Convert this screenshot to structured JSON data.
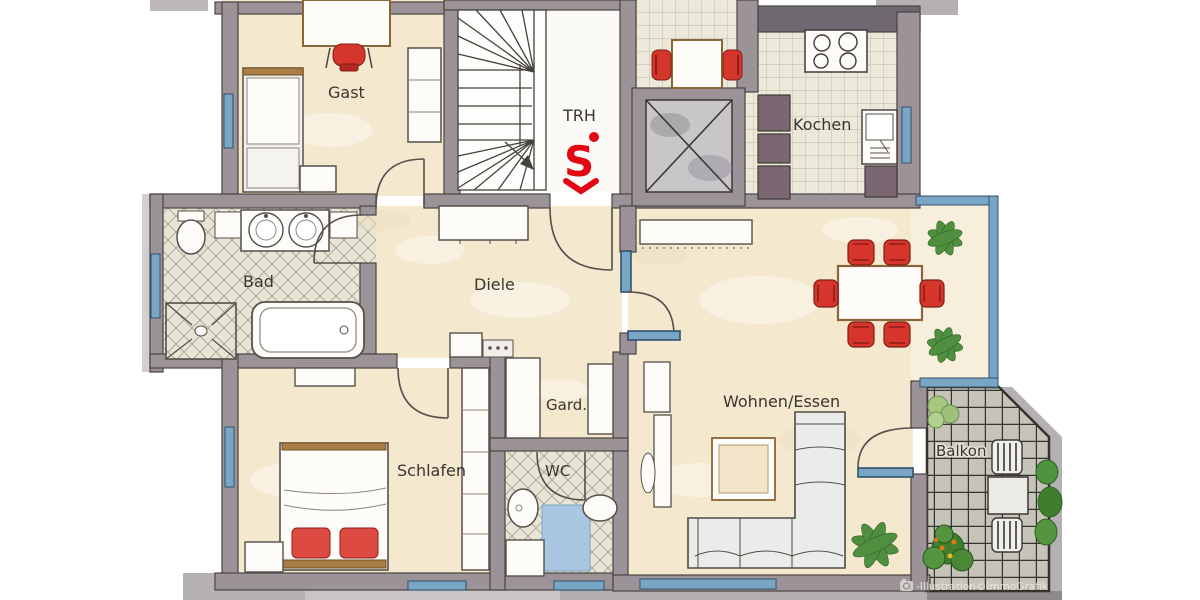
{
  "plan": {
    "type": "apartment-floor-plan",
    "rooms": {
      "gast": "Gast",
      "trh": "TRH",
      "kochen": "Kochen",
      "bad": "Bad",
      "diele": "Diele",
      "gard": "Gard.",
      "schlafen": "Schlafen",
      "wc": "WC",
      "wohnen_essen": "Wohnen/Essen",
      "balkon": "Balkon"
    },
    "logo": {
      "name": "sparkasse-logo",
      "letter": "S"
    },
    "watermark": "-Illustration©ImmoGrafik",
    "colors": {
      "floor_cream": "#f4e8cf",
      "wall_gray": "#9c9399",
      "accent_red": "#d6352c",
      "window_blue": "#7aa6c6",
      "counter_dark": "#7b6771",
      "balcony_tile": "#c6c3b8",
      "plant_green": "#4f8f3f"
    }
  }
}
